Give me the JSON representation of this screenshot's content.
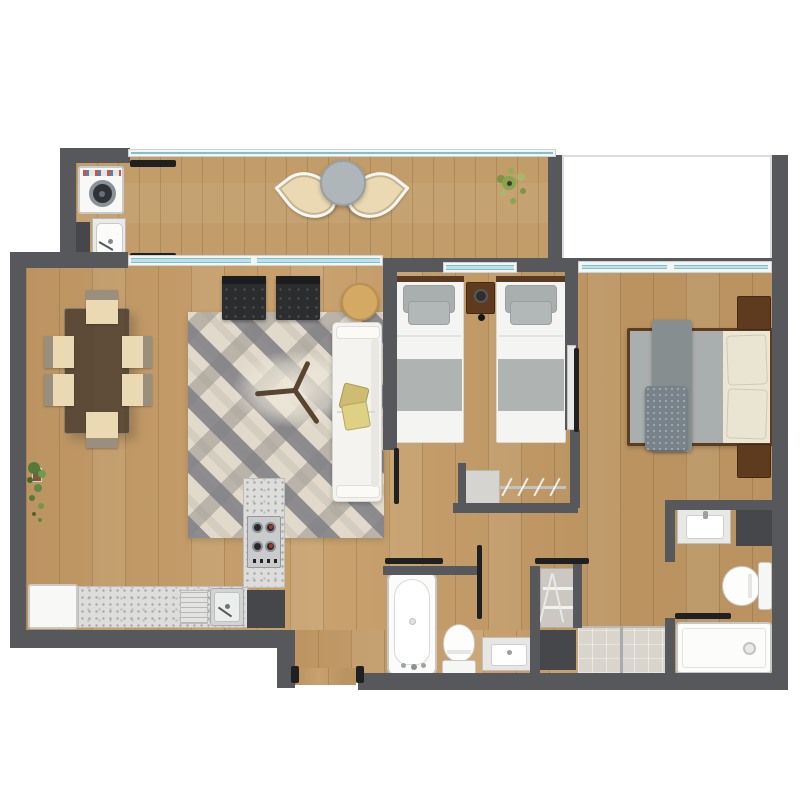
{
  "meta": {
    "title": "apartment-floor-plan",
    "view": "top-down",
    "style": "rendered 2D plan, no text labels"
  },
  "palette": {
    "wall": "#57585b",
    "wood": "#c59c66",
    "balcony-wood": "#c29d69",
    "glass": "#bfe2e8",
    "glass-frame": "#f3f4f4",
    "granite": "#dddddb",
    "rug-base": "#d3ccbf",
    "rug-stripe-a": "rgba(128,127,132,0.85)",
    "rug-stripe-b": "rgba(158,153,146,0.60)",
    "rug-stripe-c": "rgba(236,229,215,0.55)",
    "dark-chair": "#2c2d2f",
    "dark-cabinet": "#46474a",
    "wood-furniture": "#5e3a1e",
    "white-fixture": "#f8f8f6",
    "fixture-border": "#c9c9c7",
    "tile": "#d9d5cd",
    "plant-green": "#5d8440",
    "track-black": "#1f2022",
    "bed-gray": "#a9aeae",
    "cream": "#ece6d6",
    "chair-cream": "#ead9b2",
    "chair-back": "#9a8f7c",
    "pillow-yellow": "#cdbc72",
    "table-glass": "rgba(66,54,42,0.78)",
    "round-table-wood": "#d4a964",
    "terrace-white": "#ffffff",
    "terrace-border": "#dcdcdc"
  },
  "rooms": {
    "balcony": {
      "label": "Balcony terrace with laundry corner",
      "items": [
        "washing-machine",
        "laundry-sink",
        "lounge-chair",
        "lounge-chair",
        "bistro-table",
        "potted-plant",
        "glass-railing",
        "sliding-door"
      ]
    },
    "living_dining": {
      "label": "Open living and dining room",
      "items": [
        "dining-table",
        "dining-chair",
        "dining-chair",
        "dining-chair",
        "dining-chair",
        "dining-chair",
        "dining-chair",
        "area-rug",
        "armchair",
        "armchair",
        "round-side-table",
        "sofa",
        "throw-pillows",
        "y-shaped-coffee-table",
        "potted-plant"
      ]
    },
    "kitchen": {
      "label": "Open kitchen",
      "items": [
        "refrigerator",
        "granite-counter",
        "double-sink",
        "cooktop",
        "dark-cabinet"
      ]
    },
    "bedroom_1": {
      "label": "Bedroom with twin beds",
      "items": [
        "single-bed",
        "single-bed",
        "nightstand-with-lamp",
        "window",
        "closet-shelf",
        "closet-rod",
        "hangers",
        "sliding-door"
      ]
    },
    "master_bedroom": {
      "label": "Master bedroom",
      "items": [
        "double-bed",
        "nightstand",
        "nightstand",
        "bed-runner",
        "textured-throw",
        "window",
        "window",
        "sliding-door"
      ]
    },
    "bathroom": {
      "label": "Main bathroom",
      "items": [
        "bathtub",
        "toilet",
        "vanity-sink",
        "sliding-door"
      ]
    },
    "linen_closet": {
      "label": "Linen closet",
      "items": [
        "wire-shelves",
        "dark-cabinet",
        "sliding-door",
        "tiled-shower-area"
      ]
    },
    "ensuite_bathroom": {
      "label": "En-suite bathroom",
      "items": [
        "vanity-sink",
        "dark-cabinet",
        "toilet",
        "shower-tray",
        "sliding-door"
      ]
    },
    "entry": {
      "label": "Entry vestibule",
      "items": [
        "door-posts"
      ]
    }
  }
}
